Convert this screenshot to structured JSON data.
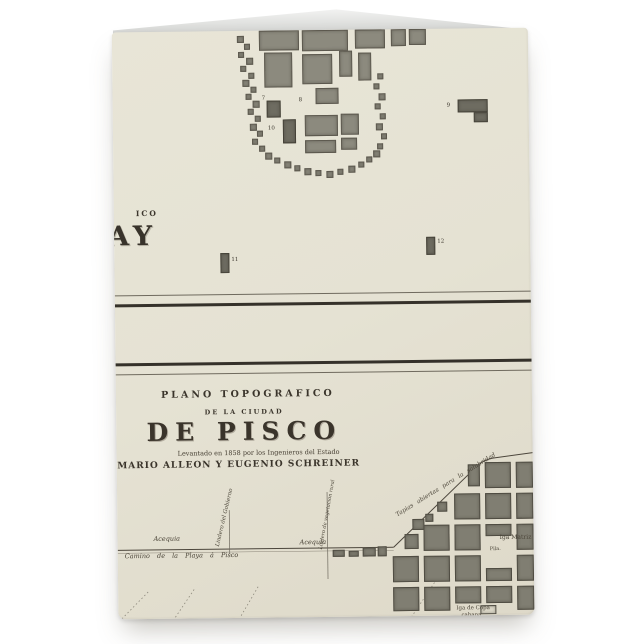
{
  "product": {
    "background_color": "#ffffff"
  },
  "card": {
    "front_color": "#e5e2d3",
    "ink_color": "#39332a",
    "block_color": "#8c8a7e",
    "dark_block_color": "#6e6c61"
  },
  "top_map": {
    "corner_text_fragment": "ICO",
    "city_name_fragment": "AY",
    "numbered_labels": [
      {
        "n": "7",
        "x": 149,
        "y": 65
      },
      {
        "n": "8",
        "x": 186,
        "y": 67
      },
      {
        "n": "9",
        "x": 334,
        "y": 74
      },
      {
        "n": "10",
        "x": 155,
        "y": 95
      },
      {
        "n": "11",
        "x": 117,
        "y": 226
      },
      {
        "n": "12",
        "x": 323,
        "y": 210
      }
    ],
    "blocks": [
      [
        147,
        0,
        40,
        20
      ],
      [
        190,
        0,
        46,
        21
      ],
      [
        243,
        0,
        30,
        19
      ],
      [
        279,
        0,
        15,
        17
      ],
      [
        297,
        0,
        17,
        16
      ],
      [
        152,
        22,
        28,
        35
      ],
      [
        190,
        24,
        30,
        30
      ],
      [
        227,
        21,
        13,
        26
      ],
      [
        246,
        23,
        13,
        28
      ],
      [
        203,
        58,
        23,
        16
      ],
      [
        192,
        85,
        33,
        21
      ],
      [
        228,
        84,
        18,
        21
      ],
      [
        192,
        110,
        31,
        13
      ],
      [
        228,
        108,
        16,
        12
      ]
    ],
    "dark_blocks": [
      [
        154,
        70,
        14,
        17
      ],
      [
        170,
        89,
        13,
        24
      ],
      [
        345,
        71,
        30,
        13
      ],
      [
        361,
        84,
        14,
        10
      ],
      [
        106,
        222,
        9,
        20
      ],
      [
        312,
        208,
        9,
        18
      ]
    ],
    "small_blocks": [
      [
        125,
        5,
        7
      ],
      [
        132,
        13,
        6
      ],
      [
        126,
        21,
        6
      ],
      [
        134,
        27,
        7
      ],
      [
        128,
        35,
        6
      ],
      [
        136,
        42,
        6
      ],
      [
        130,
        49,
        7
      ],
      [
        138,
        56,
        6
      ],
      [
        133,
        63,
        6
      ],
      [
        140,
        70,
        7
      ],
      [
        135,
        78,
        6
      ],
      [
        142,
        85,
        6
      ],
      [
        137,
        93,
        7
      ],
      [
        144,
        100,
        6
      ],
      [
        139,
        108,
        6
      ],
      [
        146,
        115,
        6
      ],
      [
        152,
        122,
        7
      ],
      [
        161,
        127,
        6
      ],
      [
        171,
        131,
        7
      ],
      [
        181,
        135,
        6
      ],
      [
        191,
        138,
        7
      ],
      [
        202,
        140,
        6
      ],
      [
        213,
        141,
        7
      ],
      [
        224,
        139,
        6
      ],
      [
        235,
        136,
        7
      ],
      [
        245,
        132,
        6
      ],
      [
        253,
        127,
        6
      ],
      [
        260,
        121,
        7
      ],
      [
        265,
        44,
        6
      ],
      [
        261,
        54,
        6
      ],
      [
        266,
        64,
        7
      ],
      [
        262,
        74,
        6
      ],
      [
        267,
        84,
        6
      ],
      [
        263,
        94,
        7
      ],
      [
        268,
        104,
        6
      ],
      [
        264,
        114,
        6
      ]
    ]
  },
  "pisco_map": {
    "title_line1": "PLANO TOPOGRAFICO",
    "title_line2": "DE LA CIUDAD",
    "title_main": "DE PISCO",
    "subtitle": "Levantado en 1858 por los Ingenieros del Estado",
    "authors": "MARIO ALLEON Y EUGENIO SCHREINER",
    "labels": [
      {
        "text": "Acequia",
        "x": 36,
        "y": 503,
        "size": 6.5,
        "it": 1
      },
      {
        "text": "Lindero del Gobierno",
        "x": 103,
        "y": 510,
        "size": 5.5,
        "it": 1,
        "rot": -76
      },
      {
        "text": "Acequia",
        "x": 182,
        "y": 508,
        "size": 6.5,
        "it": 1
      },
      {
        "text": "Lindero de vegetacion rural",
        "x": 206,
        "y": 514,
        "size": 5,
        "it": 1,
        "rot": -79
      },
      {
        "text": "Camino de la Playa á Pisco",
        "x": 7,
        "y": 520,
        "size": 6.5,
        "it": 1,
        "ws": 5
      },
      {
        "text": "Tapias abiertas para la salubridad",
        "x": 281,
        "y": 482,
        "size": 6,
        "it": 1,
        "rot": -31,
        "ws": 3
      },
      {
        "text": "Iga Matriz",
        "x": 382,
        "y": 506,
        "size": 6
      },
      {
        "text": "Pila.",
        "x": 372,
        "y": 518,
        "size": 5
      },
      {
        "text": "Iga de Copa",
        "x": 338,
        "y": 577,
        "size": 5.5
      },
      {
        "text": "cabana",
        "x": 343,
        "y": 584,
        "size": 5.5
      }
    ],
    "town_blocks": [
      [
        351,
        436,
        12,
        22
      ],
      [
        368,
        434,
        26,
        26
      ],
      [
        399,
        434,
        17,
        26
      ],
      [
        337,
        465,
        26,
        26
      ],
      [
        368,
        465,
        26,
        26
      ],
      [
        399,
        465,
        17,
        26
      ],
      [
        320,
        473,
        10,
        10
      ],
      [
        308,
        485,
        8,
        8
      ],
      [
        306,
        496,
        26,
        26
      ],
      [
        337,
        496,
        26,
        26
      ],
      [
        368,
        496,
        26,
        12
      ],
      [
        399,
        496,
        17,
        26
      ],
      [
        287,
        505,
        14,
        15
      ],
      [
        295,
        490,
        12,
        11
      ],
      [
        275,
        527,
        26,
        26
      ],
      [
        306,
        527,
        26,
        26
      ],
      [
        337,
        527,
        26,
        26
      ],
      [
        368,
        540,
        26,
        13
      ],
      [
        399,
        527,
        17,
        26
      ],
      [
        275,
        558,
        26,
        24
      ],
      [
        306,
        558,
        26,
        24
      ],
      [
        337,
        558,
        26,
        17
      ],
      [
        368,
        558,
        26,
        17
      ],
      [
        399,
        558,
        17,
        24
      ]
    ],
    "light_blocks": [
      [
        362,
        577,
        16,
        9
      ]
    ],
    "road_buildings": [
      [
        215,
        520,
        12,
        7
      ],
      [
        231,
        521,
        10,
        6
      ],
      [
        245,
        518,
        13,
        9
      ],
      [
        260,
        517,
        9,
        10
      ]
    ]
  }
}
